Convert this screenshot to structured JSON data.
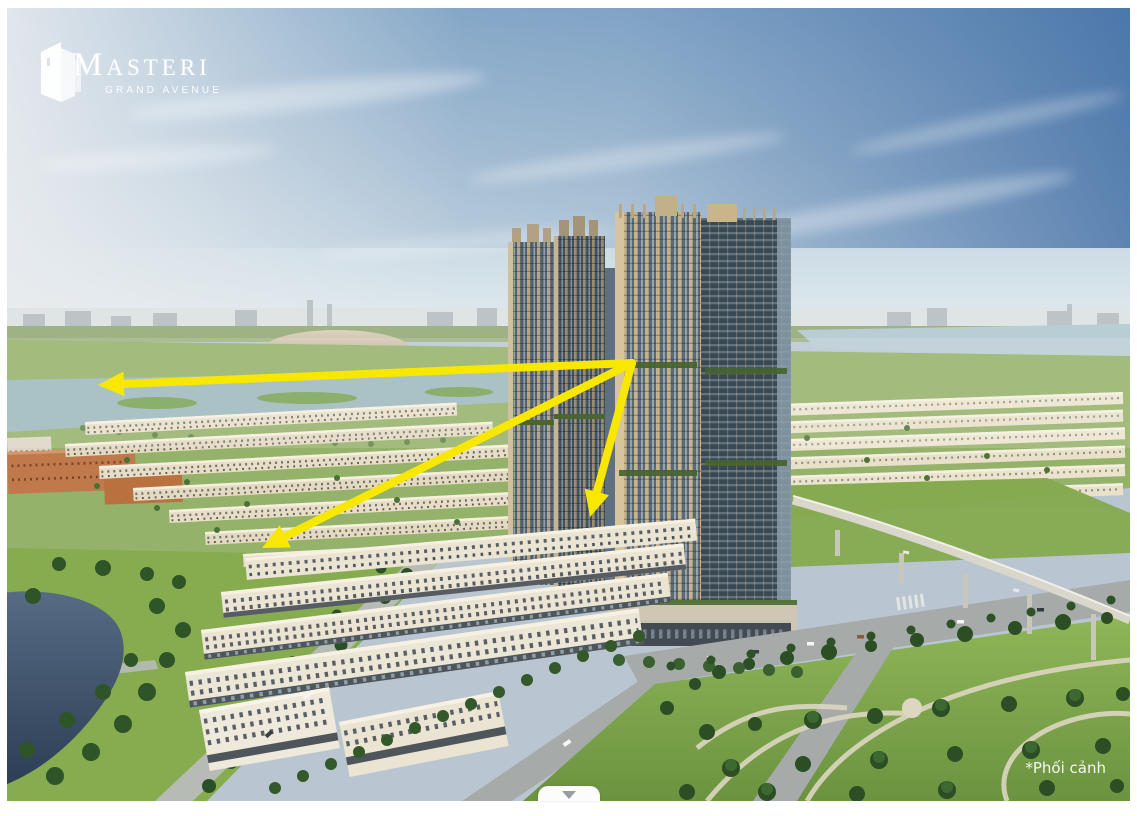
{
  "logo": {
    "brand": "MASTERI",
    "tagline": "GRAND AVENUE"
  },
  "watermark": {
    "text": "*Phối cảnh"
  },
  "scroll_indicator": {
    "icon": "chevron-down-icon"
  },
  "annotations": {
    "color": "#F8E800",
    "stroke_width": 8,
    "head_length": 26,
    "head_width": 25,
    "arrows": [
      {
        "from": {
          "x": 625,
          "y": 355
        },
        "to": {
          "x": 91,
          "y": 377
        }
      },
      {
        "from": {
          "x": 625,
          "y": 355
        },
        "to": {
          "x": 255,
          "y": 540
        }
      },
      {
        "from": {
          "x": 625,
          "y": 355
        },
        "to": {
          "x": 583,
          "y": 509
        }
      }
    ]
  },
  "scene": {
    "description": "Aerial 3D perspective render of Masteri Grand Avenue: two clusters of beige-and-glass high-rise towers above rows of neoclassical shophouses, a dome stadium on the horizon, river, lake, central park and an elevated viaduct",
    "palette": {
      "sky_deep": "#4f7cb2",
      "sky_haze": "#ccd5dc",
      "lawn": "#86ac4f",
      "tree": "#2e5127",
      "townhouse": "#e8dec8",
      "tower_frame": "#b6a586",
      "tower_glass": "#44535f",
      "road": "#a6abaa",
      "lake": "#3e5068",
      "river": "#9db9bc",
      "logo_color": "#ffffff"
    }
  }
}
